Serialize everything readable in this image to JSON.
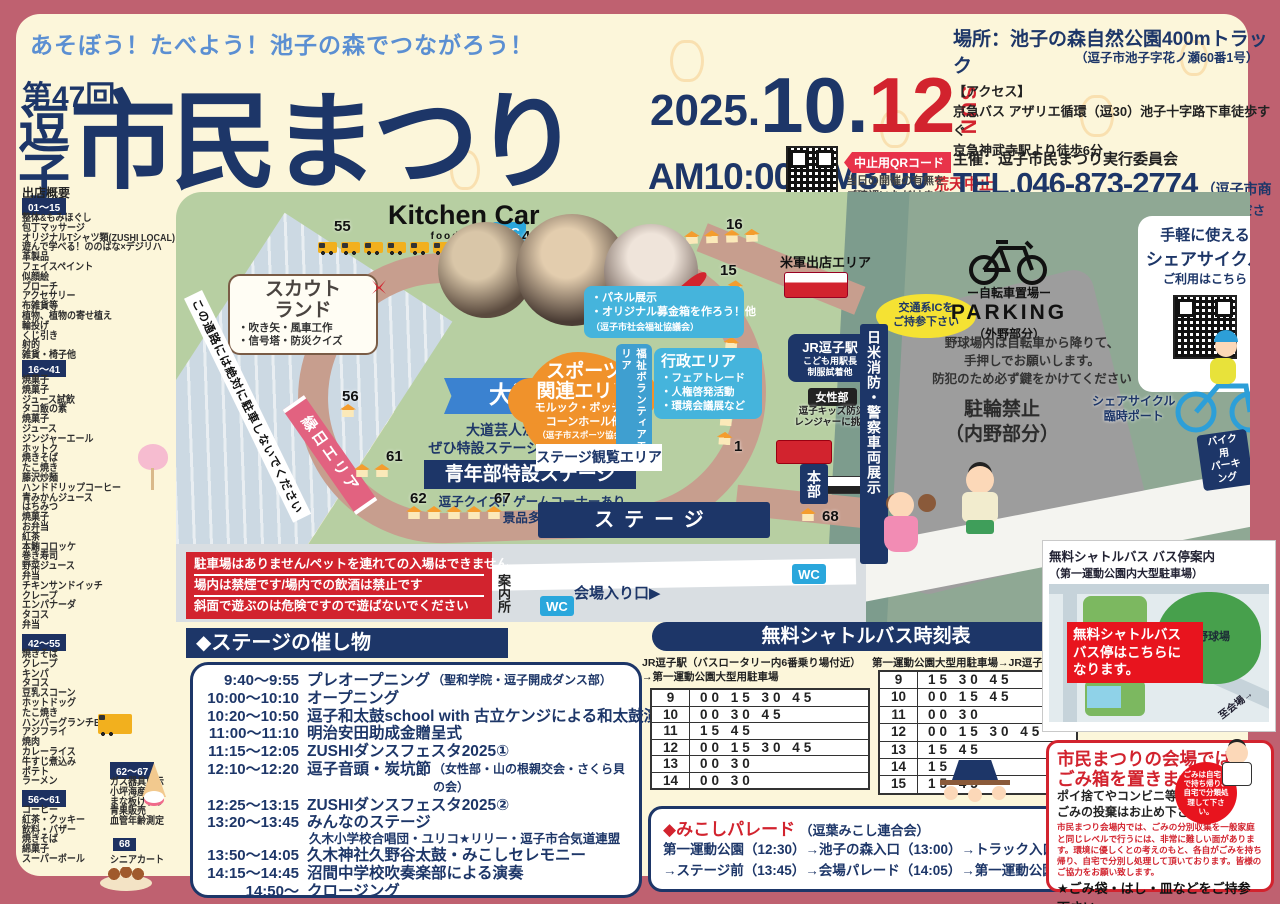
{
  "header": {
    "slogan": "あそぼう！たべよう！池子の森でつながろう！",
    "edition": "第47回",
    "title_prefix_1": "逗",
    "title_prefix_2": "子",
    "title_main": "市民まつり",
    "date_year": "2025.",
    "date_month": "10.",
    "date_day": "12",
    "date_dow": "SUN",
    "time": "AM10:00-PM3:00",
    "rain_notice": "荒天中止",
    "qr_label": "中止用QRコード",
    "qr_note_1": "当日の開催の有無を",
    "qr_note_2": "ご確認いただけます。",
    "place_title": "場所：池子の森自然公園400mトラック",
    "place_address": "（逗子市池子字花ノ瀬60番1号）",
    "access_title": "【アクセス】",
    "access_1": "京急バス アザリエ循環（逗30）池子十字路下車徒歩すぐ",
    "access_2": "京急神武寺駅より徒歩6分",
    "organizer": "主催：逗子市民まつり実行委員会",
    "tel": "TEL.046-873-2774",
    "tel_note": "（逗子市商工会）",
    "contact_note": "※市民まつり当日の問い合わせは本部までお越しください。"
  },
  "booths": {
    "heading": "出店概要",
    "groups": [
      {
        "range": "01～15",
        "items": [
          "整体&もみほぐし",
          "包丁マッサージ",
          "オリジナルTシャツ類(ZUSHI LOCAL)",
          "遊んで学べる！ののはな×デジリハ",
          "革製品",
          "フェイスペイント",
          "似顔絵",
          "ブローチ",
          "アクセサリー",
          "布雑貨等",
          "植物、植物の寄せ植え",
          "輪投げ",
          "くじ引き",
          "射的",
          "雑貨・椅子他"
        ]
      },
      {
        "range": "16～41",
        "items": [
          "焼菓子",
          "焼菓子",
          "ジュース試飲",
          "タコ飯の素",
          "焼菓子",
          "ジュース",
          "ジンジャーエール",
          "ホットク",
          "焼きそば",
          "たこ焼き",
          "藤沢炒麺",
          "ハンドドリップコーヒー",
          "青みかんジュース",
          "はちみつ",
          "焼菓子",
          "お弁当",
          "紅茶",
          "本鮪コロッケ",
          "巻き寿司",
          "野菜ジュース",
          "弁当",
          "チキンサンドイッチ",
          "クレープ",
          "エンパナーダ",
          "タコス",
          "弁当"
        ]
      },
      {
        "range": "42～55",
        "items": [
          "焼きそば",
          "クレープ",
          "キンパ",
          "タコス",
          "豆乳スコーン",
          "ホットドッグ",
          "たこ焼き",
          "ハンバーグランチBOX",
          "アジフライ",
          "焼肉",
          "カレーライス",
          "牛すじ煮込み",
          "ポテト",
          "ラーメン"
        ]
      },
      {
        "range": "56～61",
        "items": [
          "コーヒー",
          "紅茶・クッキー",
          "飲料・バザー",
          "焼きそば",
          "綿菓子",
          "スーパーボール"
        ]
      },
      {
        "range": "62～67",
        "items": [
          "ガス器具展示",
          "小坪海産物",
          "まな板けずり",
          "青果販売",
          "血管年齢測定"
        ]
      },
      {
        "range": "68",
        "items": [
          "シニアカート"
        ]
      }
    ]
  },
  "map": {
    "wc": "WC",
    "kitchen_car_title": "Kitchen Car",
    "kitchen_car_sub": "food shop",
    "scout_land": {
      "title1": "スカウト",
      "title2": "ランド",
      "item1": "・吹き矢・風車工作",
      "item2": "・信号塔・防災クイズ"
    },
    "performer": {
      "banner": "大道芸人",
      "line1": "大道芸人が大集合！！",
      "line2": "ぜひ特設ステージへお越し下さい!!"
    },
    "youth_stage": {
      "title": "青年部特設ステージ",
      "line1": "逗子クイズ！ゲームコーナーあり",
      "line2": "景品多数!!"
    },
    "sports": {
      "title1": "スポーツ",
      "title2": "関連エリア",
      "line1": "モルック・ボッチャ",
      "line2": "コーンホール他",
      "line3": "（逗子市スポーツ協会）"
    },
    "welfare_label": "福祉ボランティアエリア",
    "welfare_box": {
      "line1": "・パネル展示",
      "line2": "・オリジナル募金箱を作ろう！他",
      "line3": "（逗子市社会福祉協議会）"
    },
    "gov": {
      "title": "行政エリア",
      "item1": "・フェアトレード",
      "item2": "・人権啓発活動",
      "item3": "・環境会議展など"
    },
    "us_army": "米軍出店エリア",
    "ic1": "交通系ICを",
    "ic2": "ご持参下さい",
    "jr": {
      "title": "JR逗子駅",
      "line1": "こども用駅長",
      "line2": "制服試着他"
    },
    "womens": {
      "title": "女性部",
      "line1": "逗子キッズ防災",
      "line2": "レンジャーに挑戦"
    },
    "vehicle_display": "日米消防・警察車両展示",
    "stage_view": "ステージ観覧エリア",
    "stage": "ステージ",
    "ennichi": "縁日エリア",
    "road_warning": "この通路には絶対に駐車しないでください",
    "honbu": "本部",
    "info_desk": "案内所",
    "entrance": "会場入り口▶",
    "n55": "55",
    "n42": "42",
    "n41": "41",
    "n16": "16",
    "n15": "15",
    "n1": "1",
    "n56": "56",
    "n61": "61",
    "n62": "62",
    "n67": "67",
    "n68": "68",
    "parking": {
      "word": "ー自転車置場ー",
      "title": "PARKING",
      "sub": "（外野部分）"
    },
    "share_box": {
      "line1": "手軽に使える",
      "line2": "シェアサイクル",
      "line3": "ご利用はこちら"
    },
    "bike_rules": {
      "line1": "野球場内は自転車から降りて、",
      "line2": "手押しでお願いします。",
      "line3": "防犯のため必ず鍵をかけてください"
    },
    "no_parking": {
      "line1": "駐輪禁止",
      "line2": "（内野部分）"
    },
    "share_port": {
      "line1": "シェアサイクル",
      "line2": "臨時ポート"
    },
    "bike_park": {
      "line1": "バイク用",
      "line2": "パーキング"
    }
  },
  "warnings": {
    "lines": [
      "駐車場はありません/ペットを連れての入場はできません",
      "場内は禁煙です/場内での飲酒は禁止です",
      "斜面で遊ぶのは危険ですので遊ばないでください"
    ]
  },
  "stage_program": {
    "heading": "◆ステージの催し物",
    "rows": [
      {
        "time": "9:40～9:55",
        "title": "プレオープニング",
        "note": "（聖和学院・逗子開成ダンス部）"
      },
      {
        "time": "10:00～10:10",
        "title": "オープニング"
      },
      {
        "time": "10:20～10:50",
        "title": "逗子和太鼓school with 古立ケンジによる和太鼓演奏"
      },
      {
        "time": "11:00～11:10",
        "title": "明治安田助成金贈呈式"
      },
      {
        "time": "11:15～12:05",
        "title": "ZUSHIダンスフェスタ2025①"
      },
      {
        "time": "12:10～12:20",
        "title": "逗子音頭・炭坑節",
        "note": "（女性部・山の根親交会・さくら貝の会）"
      },
      {
        "time": "12:25～13:15",
        "title": "ZUSHIダンスフェスタ2025②"
      },
      {
        "time": "13:20～13:45",
        "title": "みんなのステージ",
        "sub": "久木小学校合唱団・ユリコ★リリー・逗子市合気道連盟"
      },
      {
        "time": "13:50～14:05",
        "title": "久木神社久野谷太鼓・みこしセレモニー"
      },
      {
        "time": "14:15～14:45",
        "title": "沼間中学校吹奏楽部による演奏"
      },
      {
        "time": "14:50～",
        "title": "クロージング"
      }
    ]
  },
  "shuttle": {
    "heading": "無料シャトルバス時刻表",
    "left_caption_1": "JR逗子駅（バスロータリー内6番乗り場付近）",
    "left_caption_2": "→第一運動公園大型用駐車場",
    "right_caption": "第一運動公園大型用駐車場→JR逗子駅",
    "left_rows": [
      [
        "9",
        "00 15 30 45"
      ],
      [
        "10",
        "00 30 45"
      ],
      [
        "11",
        "15 45"
      ],
      [
        "12",
        "00 15 30 45"
      ],
      [
        "13",
        "00 30"
      ],
      [
        "14",
        "00 30"
      ]
    ],
    "right_rows": [
      [
        "9",
        "15 30 45"
      ],
      [
        "10",
        "00 15 45"
      ],
      [
        "11",
        "00 30"
      ],
      [
        "12",
        "00 15 30 45"
      ],
      [
        "13",
        "15 45"
      ],
      [
        "14",
        "15 45"
      ],
      [
        "15",
        "15 45"
      ]
    ]
  },
  "mikoshi": {
    "title": "◆みこしパレード",
    "org": "（逗葉みこし連合会）",
    "route1": "第一運動公園（12:30）→池子の森入口（13:00）→トラック入口（13:30）",
    "route2": "→ステージ前（13:45）→会場パレード（14:05）→第一運動公園（15:45）"
  },
  "busmap": {
    "title": "無料シャトルバス バス停案内",
    "subtitle": "（第一運動公園内大型駐車場）",
    "field": "野球場",
    "callout1": "無料シャトルバス",
    "callout2": "バス停はこちらに",
    "callout3": "なります。",
    "to_venue": "至会場→"
  },
  "garbage": {
    "title1": "市民まつりの会場では",
    "title2": "ごみ箱を置きません",
    "sub1": "ポイ捨てやコンビニ等への",
    "sub2": "ごみの投棄はお止め下さい",
    "badge": "ごみは自宅まで持ち帰り、自宅で分類処理して下さい。",
    "para": "市民まつり会場内では、ごみの分別収集を一般家庭と同じレベルで行うには、非常に難しい面があります。環境に優しくとの考えのもと、各自がごみを持ち帰り、自宅で分別し処理して頂いております。皆様のご協力をお願い致します。",
    "star": "★ごみ袋・はし・皿などをご持参下さい。"
  }
}
